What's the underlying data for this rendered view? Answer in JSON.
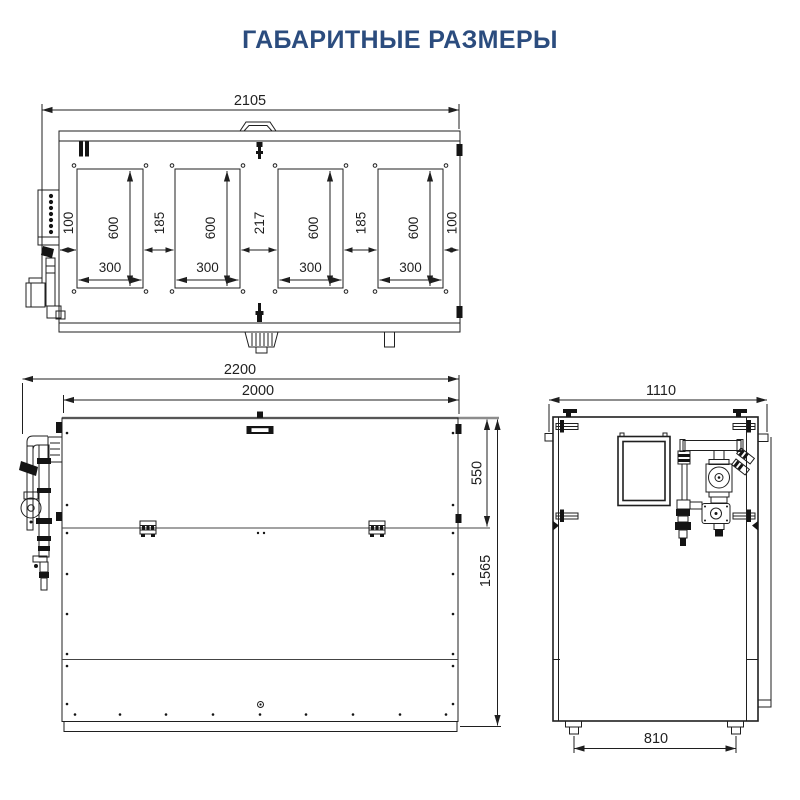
{
  "title": "ГАБАРИТНЫЕ РАЗМЕРЫ",
  "accent_color": "#2b4c7e",
  "views": {
    "top": {
      "dims": {
        "overall_length": "2105",
        "panel_height": "600",
        "panel_width": "300",
        "edge_margin": "100",
        "gap_outer": "185",
        "gap_center": "217"
      }
    },
    "front": {
      "dims": {
        "overall_length": "2200",
        "body_length": "2000",
        "top_section_height": "550",
        "overall_height": "1565"
      }
    },
    "side": {
      "dims": {
        "overall_depth": "1110",
        "feet_spacing": "810"
      }
    }
  }
}
